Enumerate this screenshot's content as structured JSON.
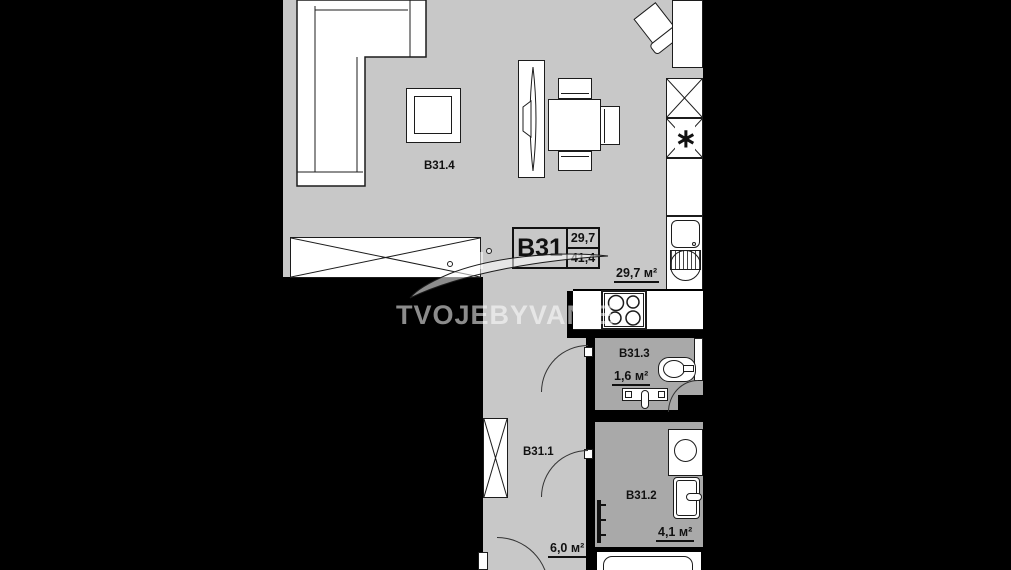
{
  "colors": {
    "floor_light": "#c8c8c8",
    "floor_dark": "#a9a9a9",
    "wall": "#000000",
    "fixture": "#ffffff",
    "line": "#1c1c1c",
    "watermark": "rgba(255,255,255,0.55)"
  },
  "watermark": {
    "brand": "TVOJEBYVANIE"
  },
  "unit_card": {
    "code": "B31",
    "area_top": "29,7",
    "area_bottom": "41,4"
  },
  "rooms": {
    "living": {
      "label": "B31.4"
    },
    "kitchen": {
      "area": "29,7 м²"
    },
    "wc": {
      "label": "B31.3",
      "area": "1,6 м²"
    },
    "hall": {
      "label": "B31.1",
      "area": "6,0 м²"
    },
    "bath": {
      "label": "B31.2",
      "area": "4,1 м²"
    }
  },
  "icons": {
    "freezer_star": "∗"
  }
}
